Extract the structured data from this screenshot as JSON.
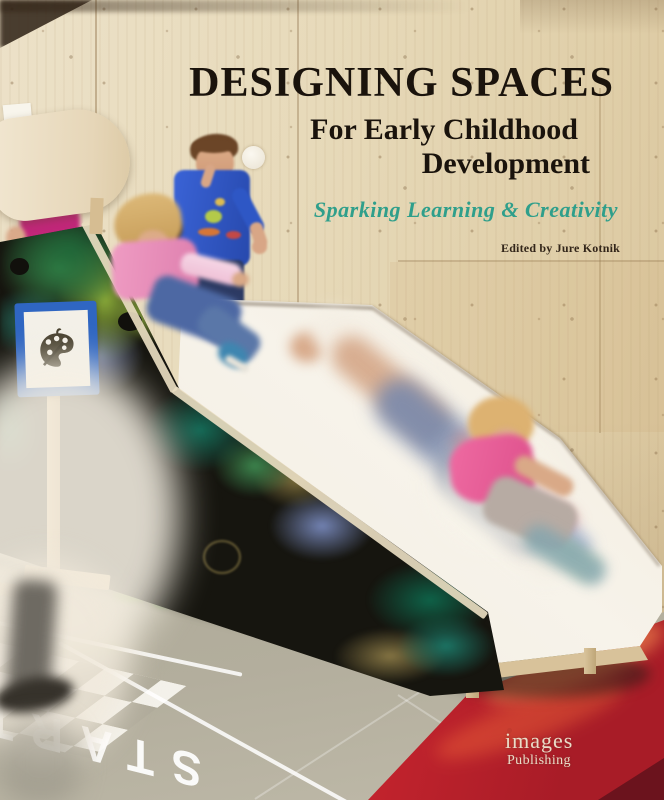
{
  "cover": {
    "title": "DESIGNING SPACES",
    "subtitle": [
      "For Early Childhood",
      "Development"
    ],
    "tagline": "Sparking Learning & Creativity",
    "edited_by": "Edited by Jure Kotnik",
    "publisher": {
      "name": "images",
      "division": "Publishing"
    },
    "floor_text": "START",
    "colors": {
      "title_ink": "#1a130c",
      "tagline_teal": "#2f9f8b",
      "edited_ink": "#33261a",
      "publisher_cream": "#eadcc8",
      "publisher_dot_red": "#c23b2e",
      "wall_wood": "#e7d9ba",
      "chalkboard_black": "#16150f",
      "chalk_green": "#3f8f4e",
      "chalk_lime": "#9cc23f",
      "chalk_teal": "#1d8573",
      "chalk_blue": "#8090c5",
      "chalk_gold": "#9d8a4a",
      "slide_white": "#f4efe5",
      "floor_gray": "#b0ac9c",
      "mat_red": "#d32b31",
      "sign_blue": "#2f66c2",
      "boy_shirt_blue": "#2e57c5",
      "girl_shirt_pink": "#e78db8",
      "kid_shirt_magenta": "#c12779"
    }
  }
}
